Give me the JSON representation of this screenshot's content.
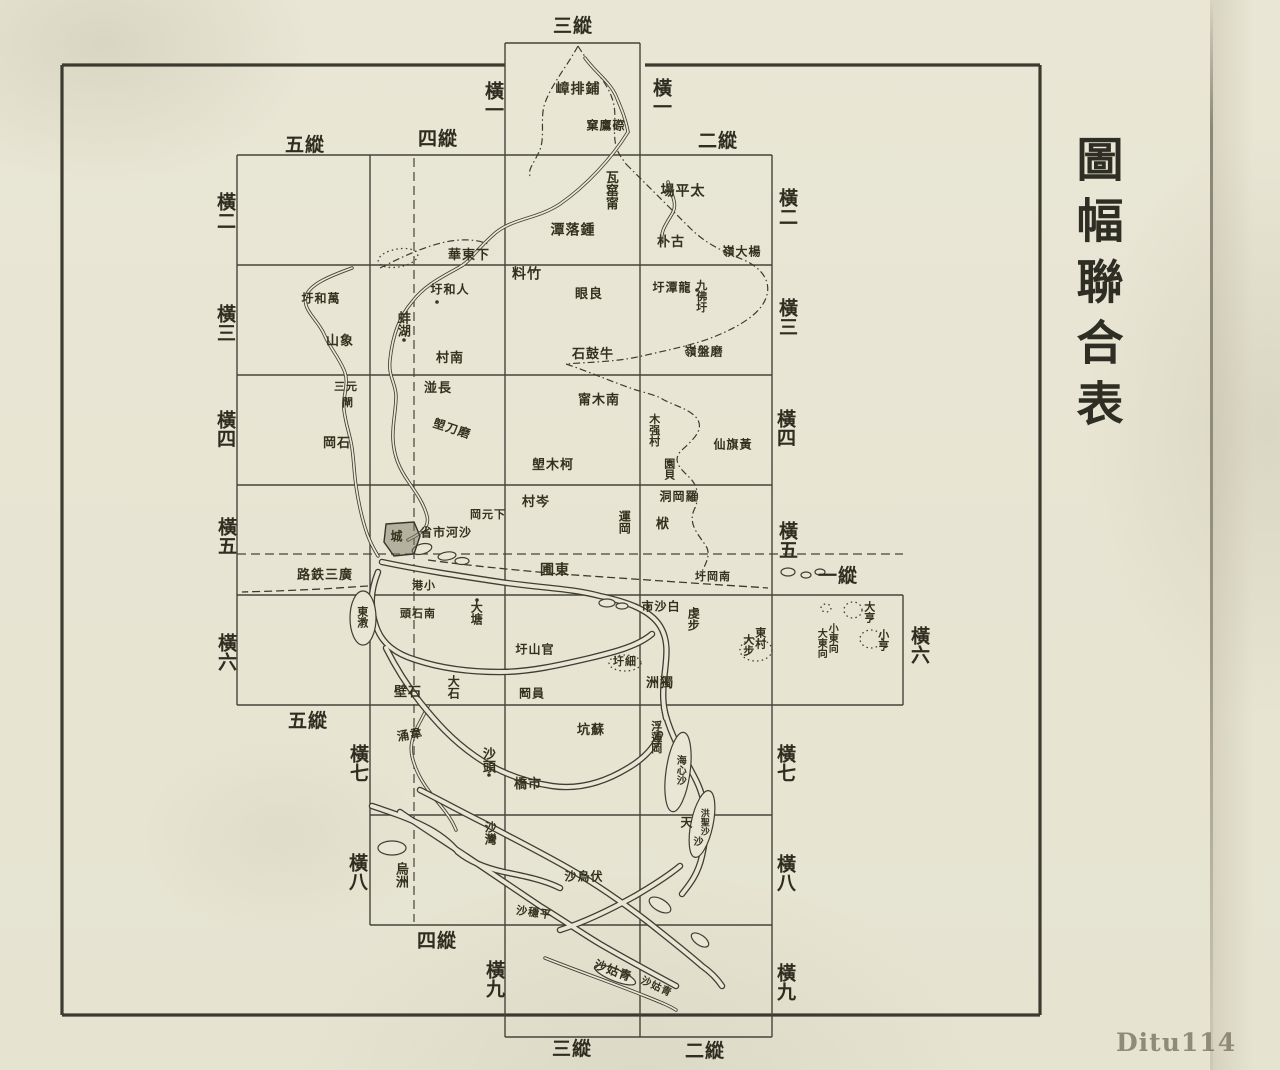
{
  "page": {
    "title_vertical": "圖幅聯合表",
    "watermark": "Ditu114"
  },
  "colors": {
    "paper": "#e9e6d5",
    "ink": "#3a3848",
    "line": "#45443a",
    "watermark_gray": "#8f8b79"
  },
  "grid_labels": {
    "columns": [
      {
        "label": "三縱",
        "x": 573,
        "y": 27
      },
      {
        "label": "五縱",
        "x": 305,
        "y": 146
      },
      {
        "label": "四縱",
        "x": 438,
        "y": 140
      },
      {
        "label": "二縱",
        "x": 718,
        "y": 142
      },
      {
        "label": "一縱",
        "x": 838,
        "y": 577
      },
      {
        "label": "五縱",
        "x": 308,
        "y": 722
      },
      {
        "label": "四縱",
        "x": 437,
        "y": 942
      },
      {
        "label": "三縱",
        "x": 572,
        "y": 1050
      },
      {
        "label": "二縱",
        "x": 705,
        "y": 1052
      }
    ],
    "rows_left": [
      {
        "label": "橫一",
        "x": 492,
        "y": 100
      },
      {
        "label": "橫二",
        "x": 224,
        "y": 211
      },
      {
        "label": "橫三",
        "x": 224,
        "y": 323
      },
      {
        "label": "橫四",
        "x": 224,
        "y": 429
      },
      {
        "label": "橫五",
        "x": 225,
        "y": 536
      },
      {
        "label": "橫六",
        "x": 225,
        "y": 652
      },
      {
        "label": "橫七",
        "x": 357,
        "y": 763
      },
      {
        "label": "橫八",
        "x": 356,
        "y": 872
      },
      {
        "label": "橫九",
        "x": 493,
        "y": 979
      }
    ],
    "rows_right": [
      {
        "label": "橫一",
        "x": 660,
        "y": 97
      },
      {
        "label": "橫二",
        "x": 786,
        "y": 207
      },
      {
        "label": "橫三",
        "x": 786,
        "y": 317
      },
      {
        "label": "橫四",
        "x": 784,
        "y": 428
      },
      {
        "label": "橫五",
        "x": 786,
        "y": 540
      },
      {
        "label": "橫六",
        "x": 918,
        "y": 645
      },
      {
        "label": "橫七",
        "x": 784,
        "y": 763
      },
      {
        "label": "橫八",
        "x": 784,
        "y": 873
      },
      {
        "label": "橫九",
        "x": 784,
        "y": 982
      }
    ]
  },
  "map_labels": [
    {
      "text": "嶂排鋪",
      "x": 578,
      "y": 90,
      "o": "h",
      "s": 14
    },
    {
      "text": "窠鷹磜",
      "x": 606,
      "y": 126,
      "o": "h",
      "s": 12
    },
    {
      "text": "瓦窰甯",
      "x": 610,
      "y": 190,
      "o": "v",
      "s": 13
    },
    {
      "text": "場平太",
      "x": 683,
      "y": 192,
      "o": "h",
      "s": 14
    },
    {
      "text": "潭落鍾",
      "x": 573,
      "y": 231,
      "o": "h",
      "s": 14
    },
    {
      "text": "朴古",
      "x": 671,
      "y": 243,
      "o": "h",
      "s": 13
    },
    {
      "text": "嶺大楊",
      "x": 742,
      "y": 252,
      "o": "h",
      "s": 12
    },
    {
      "text": "華東下",
      "x": 469,
      "y": 256,
      "o": "h",
      "s": 13
    },
    {
      "text": "料竹",
      "x": 527,
      "y": 275,
      "o": "h",
      "s": 14
    },
    {
      "text": "圩和人",
      "x": 450,
      "y": 290,
      "o": "h",
      "s": 12
    },
    {
      "text": "圩和萬",
      "x": 321,
      "y": 299,
      "o": "h",
      "s": 12
    },
    {
      "text": "圩潭龍",
      "x": 672,
      "y": 288,
      "o": "h",
      "s": 12
    },
    {
      "text": "九佛圩",
      "x": 701,
      "y": 296,
      "o": "v",
      "s": 11
    },
    {
      "text": "眼良",
      "x": 589,
      "y": 295,
      "o": "h",
      "s": 13
    },
    {
      "text": "蚌湖",
      "x": 402,
      "y": 324,
      "o": "v",
      "s": 13
    },
    {
      "text": "山象",
      "x": 340,
      "y": 342,
      "o": "h",
      "s": 13
    },
    {
      "text": "村南",
      "x": 450,
      "y": 359,
      "o": "h",
      "s": 13
    },
    {
      "text": "嶺盤磨",
      "x": 704,
      "y": 352,
      "o": "h",
      "s": 12
    },
    {
      "text": "石鼓牛",
      "x": 593,
      "y": 355,
      "o": "h",
      "s": 13
    },
    {
      "text": "湴長",
      "x": 438,
      "y": 389,
      "o": "h",
      "s": 13
    },
    {
      "text": "三元",
      "x": 346,
      "y": 387,
      "o": "h",
      "s": 11
    },
    {
      "text": "閘",
      "x": 348,
      "y": 403,
      "o": "h",
      "s": 11
    },
    {
      "text": "甯木南",
      "x": 599,
      "y": 401,
      "o": "h",
      "s": 13
    },
    {
      "text": "木强村",
      "x": 654,
      "y": 430,
      "o": "v",
      "s": 11
    },
    {
      "text": "塱刀磨",
      "x": 452,
      "y": 429,
      "o": "h",
      "s": 12,
      "r": 18
    },
    {
      "text": "岡石",
      "x": 337,
      "y": 444,
      "o": "h",
      "s": 13
    },
    {
      "text": "仙旗黃",
      "x": 733,
      "y": 445,
      "o": "h",
      "s": 12
    },
    {
      "text": "園貝",
      "x": 669,
      "y": 469,
      "o": "v",
      "s": 11
    },
    {
      "text": "塱木柯",
      "x": 553,
      "y": 466,
      "o": "h",
      "s": 13
    },
    {
      "text": "村岑",
      "x": 536,
      "y": 503,
      "o": "h",
      "s": 13
    },
    {
      "text": "岡元下",
      "x": 488,
      "y": 515,
      "o": "h",
      "s": 11
    },
    {
      "text": "洞岡羅",
      "x": 679,
      "y": 497,
      "o": "h",
      "s": 12
    },
    {
      "text": "運岡",
      "x": 624,
      "y": 522,
      "o": "v",
      "s": 12
    },
    {
      "text": "栿",
      "x": 663,
      "y": 525,
      "o": "h",
      "s": 13
    },
    {
      "text": "城",
      "x": 397,
      "y": 537,
      "o": "h",
      "s": 12
    },
    {
      "text": "省市河沙",
      "x": 446,
      "y": 533,
      "o": "h",
      "s": 12
    },
    {
      "text": "路鉄三廣",
      "x": 325,
      "y": 576,
      "o": "h",
      "s": 13
    },
    {
      "text": "圃東",
      "x": 555,
      "y": 571,
      "o": "h",
      "s": 14
    },
    {
      "text": "圩岡南",
      "x": 713,
      "y": 577,
      "o": "h",
      "s": 11
    },
    {
      "text": "港小",
      "x": 424,
      "y": 586,
      "o": "h",
      "s": 11
    },
    {
      "text": "頭石南",
      "x": 418,
      "y": 614,
      "o": "h",
      "s": 11
    },
    {
      "text": "東漖",
      "x": 362,
      "y": 617,
      "o": "v",
      "s": 11
    },
    {
      "text": "大塘",
      "x": 476,
      "y": 613,
      "o": "v",
      "s": 12
    },
    {
      "text": "市沙白",
      "x": 661,
      "y": 607,
      "o": "h",
      "s": 12
    },
    {
      "text": "虔步",
      "x": 693,
      "y": 619,
      "o": "v",
      "s": 12
    },
    {
      "text": "圩山官",
      "x": 535,
      "y": 650,
      "o": "h",
      "s": 12
    },
    {
      "text": "圩細",
      "x": 625,
      "y": 662,
      "o": "h",
      "s": 11
    },
    {
      "text": "東村",
      "x": 760,
      "y": 638,
      "o": "v",
      "s": 11
    },
    {
      "text": "大步",
      "x": 748,
      "y": 645,
      "o": "v",
      "s": 11
    },
    {
      "text": "大亨",
      "x": 869,
      "y": 612,
      "o": "v",
      "s": 11
    },
    {
      "text": "小亨",
      "x": 883,
      "y": 640,
      "o": "v",
      "s": 11
    },
    {
      "text": "小東向",
      "x": 831,
      "y": 638,
      "o": "v",
      "s": 10
    },
    {
      "text": "大東向",
      "x": 820,
      "y": 643,
      "o": "v",
      "s": 10
    },
    {
      "text": "洲獨",
      "x": 660,
      "y": 684,
      "o": "h",
      "s": 13
    },
    {
      "text": "岡員",
      "x": 532,
      "y": 694,
      "o": "h",
      "s": 12
    },
    {
      "text": "壁石",
      "x": 408,
      "y": 693,
      "o": "h",
      "s": 13
    },
    {
      "text": "大石",
      "x": 453,
      "y": 687,
      "o": "v",
      "s": 12
    },
    {
      "text": "涌韋",
      "x": 410,
      "y": 735,
      "o": "h",
      "s": 12,
      "r": -10
    },
    {
      "text": "坑蘇",
      "x": 591,
      "y": 731,
      "o": "h",
      "s": 13
    },
    {
      "text": "浮蓮岡",
      "x": 656,
      "y": 737,
      "o": "v",
      "s": 11
    },
    {
      "text": "海心沙",
      "x": 679,
      "y": 770,
      "o": "v",
      "s": 10
    },
    {
      "text": "沙頭",
      "x": 487,
      "y": 760,
      "o": "v",
      "s": 13
    },
    {
      "text": "橋市",
      "x": 528,
      "y": 785,
      "o": "h",
      "s": 13
    },
    {
      "text": "天",
      "x": 687,
      "y": 823,
      "o": "h",
      "s": 12
    },
    {
      "text": "洪聖沙",
      "x": 703,
      "y": 822,
      "o": "v",
      "s": 9
    },
    {
      "text": "沙灣",
      "x": 490,
      "y": 833,
      "o": "v",
      "s": 12
    },
    {
      "text": "烏洲",
      "x": 400,
      "y": 875,
      "o": "v",
      "s": 13
    },
    {
      "text": "沙烏伏",
      "x": 584,
      "y": 877,
      "o": "h",
      "s": 12
    },
    {
      "text": "沙穩平",
      "x": 534,
      "y": 913,
      "o": "h",
      "s": 11,
      "r": 8
    },
    {
      "text": "沙姑青",
      "x": 613,
      "y": 971,
      "o": "h",
      "s": 12,
      "r": 20
    },
    {
      "text": "沙姑青",
      "x": 656,
      "y": 988,
      "o": "h",
      "s": 10,
      "r": 25
    },
    {
      "text": "沙",
      "x": 699,
      "y": 843,
      "o": "h",
      "s": 10
    }
  ]
}
